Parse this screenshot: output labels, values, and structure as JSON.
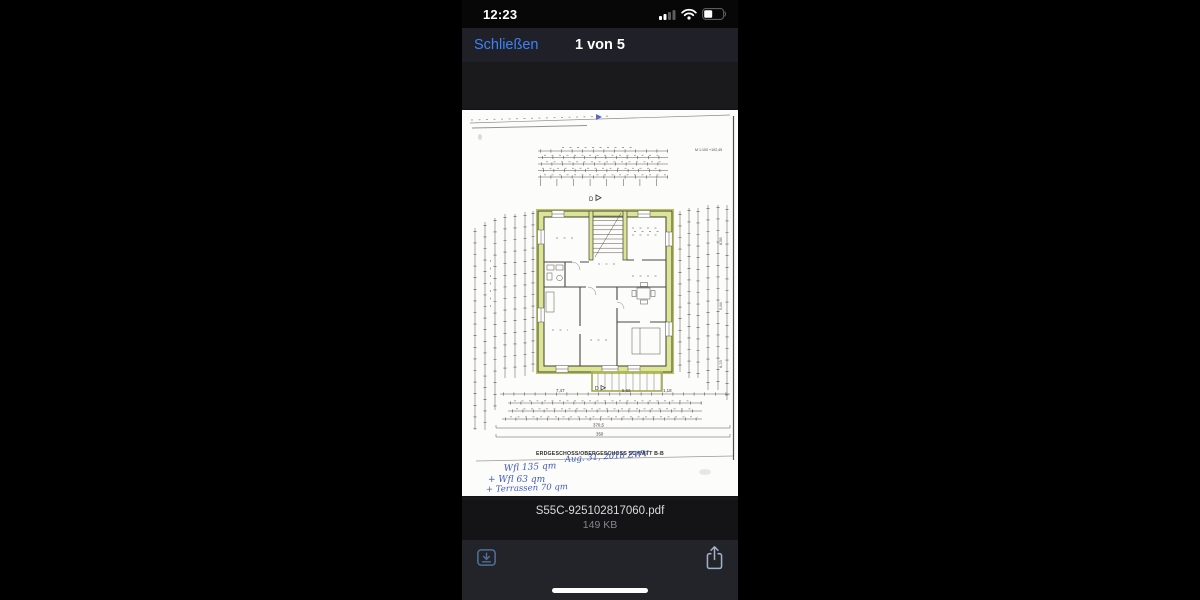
{
  "status_bar": {
    "time": "12:23"
  },
  "nav_bar": {
    "close_label": "Schließen",
    "page_indicator": "1 von 5"
  },
  "document": {
    "caption": "ERDGESCHOSS/OBERGESCHOSS   SCHNITT B-B",
    "scale_note": "M 1:100 +102,45",
    "section_marker_top": "D",
    "section_marker_bottom": "D",
    "dims": {
      "bottom_left": "7,47",
      "bottom_mid": "5,66",
      "bottom_right": "1,18",
      "total_width": "370,5",
      "total_width2": "350",
      "right_top": "8,85",
      "right_mid": "5,84",
      "right_bottom": "8,23"
    },
    "handwriting": {
      "date_note": "Aug. 31, 2018 ZWV",
      "line1": "Wfl  135 qm",
      "line2": "+ Wfl  63 qm",
      "line3": "+ Terrassen 70 qm"
    }
  },
  "file_bar": {
    "filename": "S55C-925102817060.pdf",
    "filesize": "149 KB"
  },
  "toolbar": {
    "download_icon": "download",
    "share_icon": "share"
  },
  "colors": {
    "accent_blue": "#3d82f7",
    "wall_green": "#dce593",
    "handwriting_blue": "#2b49b5"
  }
}
